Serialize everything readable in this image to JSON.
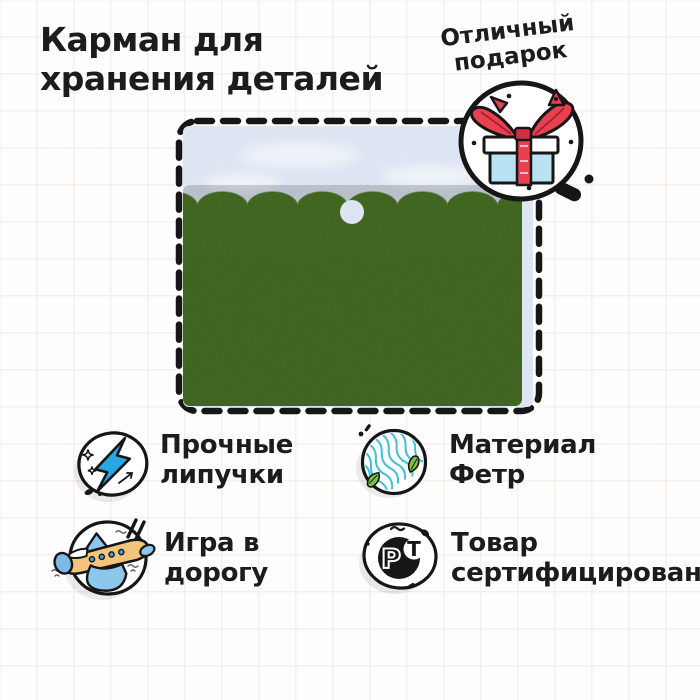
{
  "page": {
    "width": 700,
    "height": 700,
    "background": "#fdfdfd",
    "grid_line_color": "#f5efee"
  },
  "title": {
    "line1": "Карман для",
    "line2": "хранения деталей"
  },
  "gift_badge": {
    "line1": "Отличный",
    "line2": "подарок",
    "icon": "gift-icon",
    "ribbon_color": "#e8404f",
    "box_color": "#b9e2f3"
  },
  "product": {
    "description": "felt-storage-pocket-with-scalloped-edge",
    "felt_color": "#4d7a27",
    "backing_color": "#dde5f2",
    "border_color": "#161616"
  },
  "features": [
    {
      "id": "velcro",
      "icon": "lightning-icon",
      "line1": "Прочные",
      "line2": "липучки",
      "accent": "#2aa7e1"
    },
    {
      "id": "material",
      "icon": "felt-fabric-icon",
      "line1": "Материал",
      "line2": "Фетр",
      "accent": "#3fc0d8"
    },
    {
      "id": "travel",
      "icon": "airplane-icon",
      "line1": "Игра в",
      "line2": "дорогу",
      "accent": "#f3c57c"
    },
    {
      "id": "certified",
      "icon": "rst-certification-icon",
      "line1": "Товар",
      "line2": "сертифицирован",
      "accent": "#161616"
    }
  ],
  "rst_mark": {
    "letter_p": "Р",
    "letter_c": "С",
    "letter_t": "Т"
  }
}
